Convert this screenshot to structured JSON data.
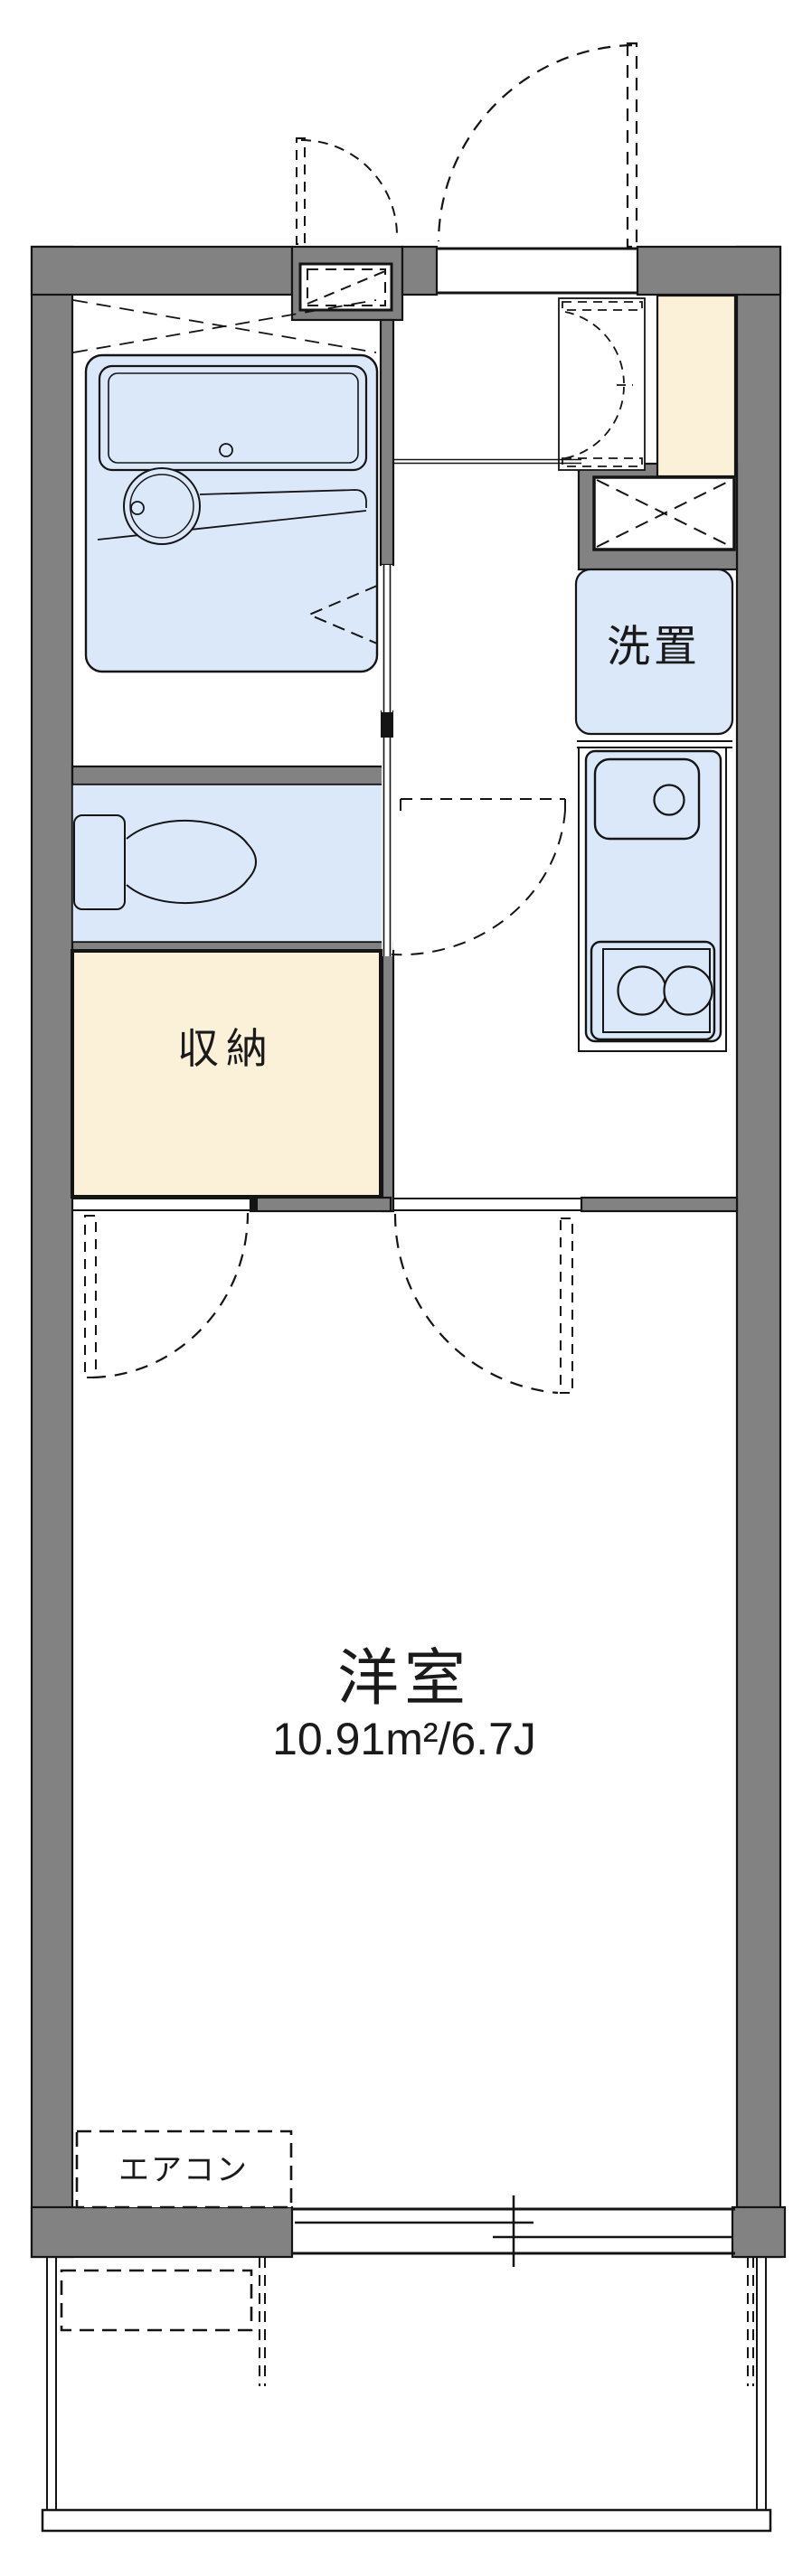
{
  "plan": {
    "type": "japanese-apartment-floorplan",
    "colors": {
      "wall_gray": "#828282",
      "outline_black": "#141414",
      "water_area_blue": "#dbe8fa",
      "storage_cream": "#fbf0d8",
      "background": "#ffffff"
    },
    "rooms": {
      "main_room": {
        "label": "洋室",
        "area": "10.91m²/6.7J"
      },
      "storage": {
        "label": "収納"
      },
      "laundry_space": {
        "label": "洗置"
      },
      "aircon": {
        "label": "エアコン"
      }
    },
    "fixtures": [
      "entrance-door",
      "meter-box",
      "bathtub",
      "wash-basin",
      "bathroom-folding-door",
      "toilet",
      "toilet-door",
      "shoe-cabinet",
      "tall-cabinet",
      "pipe-space",
      "washing-machine-space",
      "kitchen-sink",
      "two-burner-stove",
      "room-door-left",
      "room-door-right",
      "air-conditioner",
      "sliding-window",
      "balcony",
      "balcony-partition",
      "balcony-equipment-box"
    ]
  }
}
